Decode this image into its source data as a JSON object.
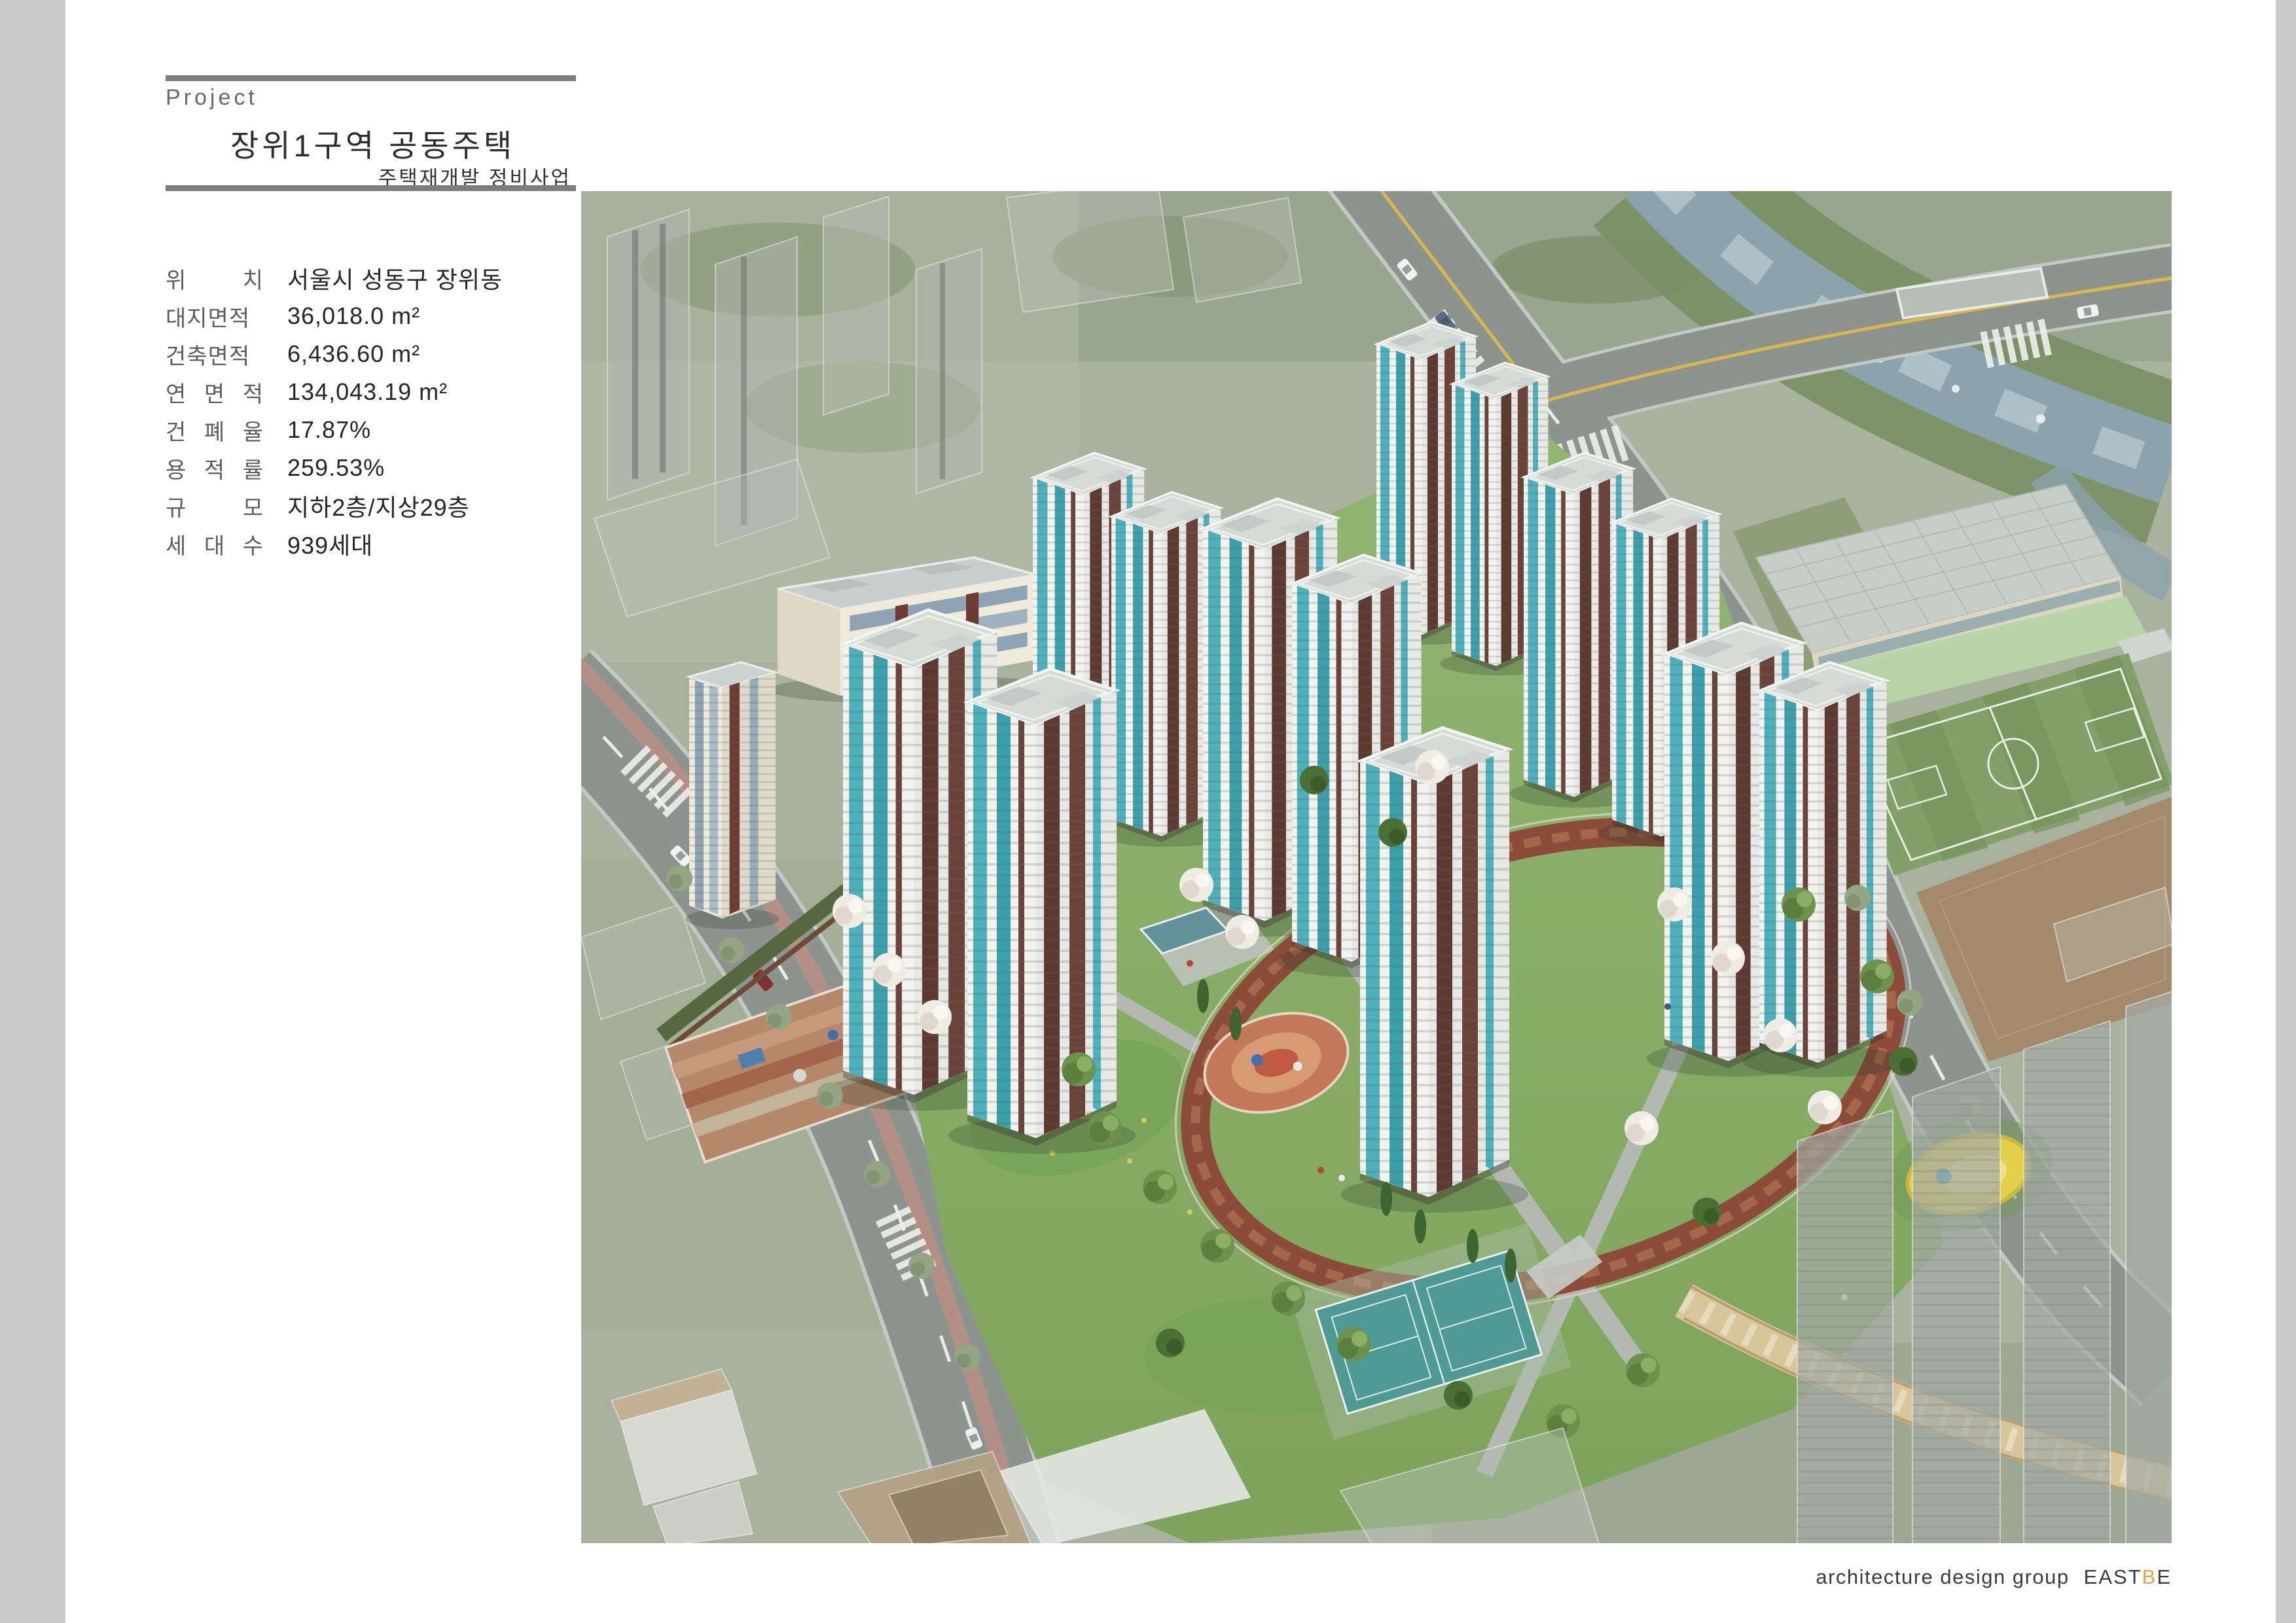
{
  "page": {
    "background": "#ffffff",
    "side_bar_color": "#cbcbcb",
    "rule_color": "#7e7e7e"
  },
  "header": {
    "eyebrow": "Project",
    "title": "장위1구역 공동주택",
    "subtitle": "주택재개발 정비사업"
  },
  "details": {
    "rows": [
      {
        "label": "위 치",
        "value": "서울시 성동구 장위동"
      },
      {
        "label": "대지면적",
        "value": "36,018.0 m²"
      },
      {
        "label": "건축면적",
        "value": "6,436.60 m²"
      },
      {
        "label": "연 면 적",
        "value": "134,043.19 m²"
      },
      {
        "label": "건 폐 율",
        "value": "17.87%"
      },
      {
        "label": "용 적 률",
        "value": "259.53%"
      },
      {
        "label": "규 모",
        "value": "지하2층/지상29층"
      },
      {
        "label": "세 대 수",
        "value": "939세대"
      }
    ]
  },
  "rendering": {
    "description": "aerial bird's-eye rendering of apartment complex site",
    "palette": {
      "background_city": "#a9b29e",
      "road": "#8d938f",
      "river": "#8aa3ac",
      "lawn": "#86ab64",
      "tower_facade": "#f3f3ee",
      "tower_accent_brown": "#5e392f",
      "tower_glass_teal": "#4db1bb",
      "ring_path": "#8d4b3a",
      "tennis_court": "#4f9a94",
      "soccer_field": "#84a06a",
      "dirt_field": "#a28a6a"
    }
  },
  "credit": {
    "prefix": "architecture design group",
    "brand_pre": "EAST",
    "brand_accent": "B",
    "brand_post": "E",
    "accent_color": "#E8A33C"
  }
}
